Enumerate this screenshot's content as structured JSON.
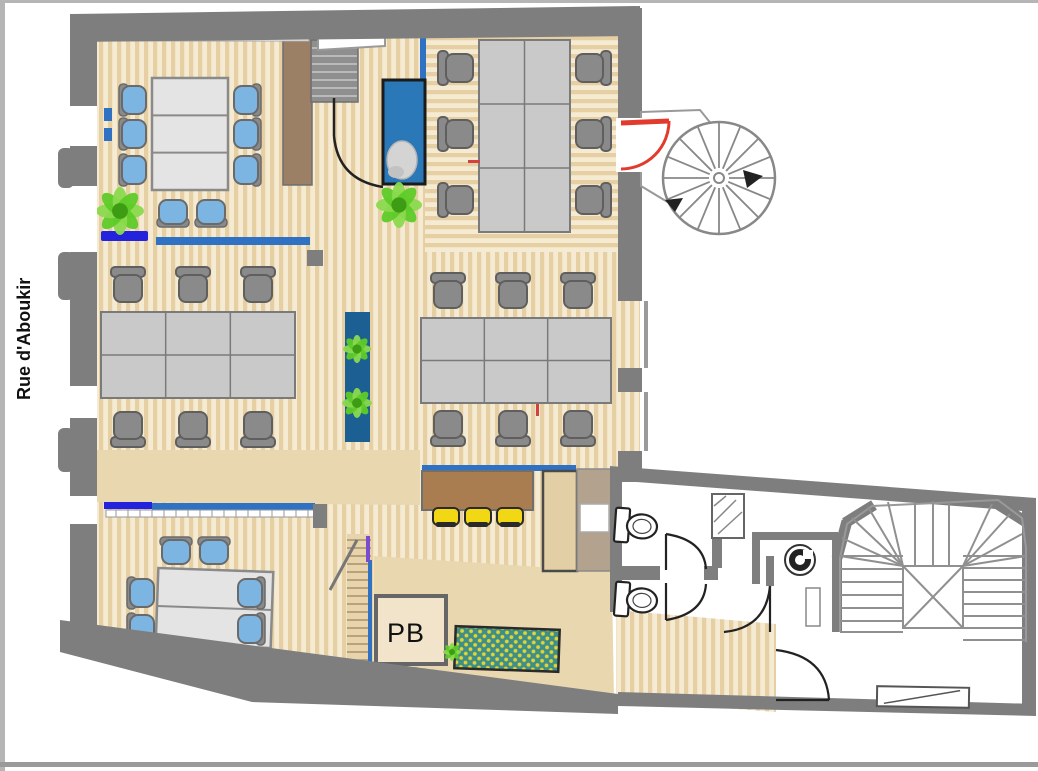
{
  "labels": {
    "street": "Rue d'Aboukir",
    "pb": "PB"
  },
  "colors": {
    "frame": "#b5b5b5",
    "wall": "#7e7e7e",
    "wallLight": "#9a9a9a",
    "floorDark": "#e6cfa3",
    "floorLight": "#f5ead2",
    "floorPlain": "#e9d7b0",
    "desk": "#c9c9c9",
    "deskLine": "#7a7a7a",
    "table": "#e4e4e4",
    "chair": "#8a8a8a",
    "chairEdge": "#5f5f5f",
    "blueChair": "#7db5e2",
    "plant": "#5ecb28",
    "plantLight": "#8bd94e",
    "plantDark": "#3e9c14",
    "glassBlue": "#2f72c4",
    "vividBlue": "#2323dd",
    "purple": "#7a4bd0",
    "aquarium": "#2a78b8",
    "aquariumFrame": "#1b1b1b",
    "planter": "#1c5f93",
    "counter": "#a97d50",
    "woodTrim": "#9b8066",
    "kitchenBlock": "#b3a28e",
    "stool": "#f2d715",
    "mat": "#3f8f86",
    "matDot": "#e3d435",
    "red": "#e23b2e",
    "door": "#222222",
    "stair": "#909090",
    "ladderTread": "#a8916a"
  },
  "plan": {
    "desk_clusters": [
      {
        "x": 479,
        "y": 40,
        "w": 91,
        "h": 192,
        "c": 2,
        "r": 3
      },
      {
        "x": 101,
        "y": 312,
        "w": 194,
        "h": 86,
        "c": 3,
        "r": 2
      },
      {
        "x": 421,
        "y": 318,
        "w": 190,
        "h": 85,
        "c": 3,
        "r": 2
      }
    ],
    "office_chairs": [
      {
        "x": 458,
        "y": 68,
        "b": "left"
      },
      {
        "x": 458,
        "y": 134,
        "b": "left"
      },
      {
        "x": 458,
        "y": 200,
        "b": "left"
      },
      {
        "x": 591,
        "y": 68,
        "b": "right"
      },
      {
        "x": 591,
        "y": 134,
        "b": "right"
      },
      {
        "x": 591,
        "y": 200,
        "b": "right"
      },
      {
        "x": 128,
        "y": 287,
        "b": "top"
      },
      {
        "x": 193,
        "y": 287,
        "b": "top"
      },
      {
        "x": 258,
        "y": 287,
        "b": "top"
      },
      {
        "x": 128,
        "y": 427,
        "b": "bottom"
      },
      {
        "x": 193,
        "y": 427,
        "b": "bottom"
      },
      {
        "x": 258,
        "y": 427,
        "b": "bottom"
      },
      {
        "x": 448,
        "y": 293,
        "b": "top"
      },
      {
        "x": 513,
        "y": 293,
        "b": "top"
      },
      {
        "x": 578,
        "y": 293,
        "b": "top"
      },
      {
        "x": 448,
        "y": 426,
        "b": "bottom"
      },
      {
        "x": 513,
        "y": 426,
        "b": "bottom"
      },
      {
        "x": 578,
        "y": 426,
        "b": "bottom"
      }
    ],
    "meeting_tables": [
      {
        "x": 152,
        "y": 78,
        "w": 76,
        "h": 112,
        "seg": 3,
        "rot": 0
      },
      {
        "x": 157,
        "y": 570,
        "w": 115,
        "h": 76,
        "seg": 2,
        "rot": 2
      }
    ],
    "blue_chairs": [
      {
        "x": 133,
        "y": 100,
        "b": "left"
      },
      {
        "x": 133,
        "y": 134,
        "b": "left"
      },
      {
        "x": 133,
        "y": 170,
        "b": "left"
      },
      {
        "x": 247,
        "y": 100,
        "b": "right"
      },
      {
        "x": 247,
        "y": 134,
        "b": "right"
      },
      {
        "x": 247,
        "y": 170,
        "b": "right"
      },
      {
        "x": 173,
        "y": 213,
        "b": "bottom"
      },
      {
        "x": 211,
        "y": 213,
        "b": "bottom"
      },
      {
        "x": 176,
        "y": 551,
        "b": "top"
      },
      {
        "x": 214,
        "y": 551,
        "b": "top"
      },
      {
        "x": 141,
        "y": 593,
        "b": "left"
      },
      {
        "x": 141,
        "y": 629,
        "b": "left"
      },
      {
        "x": 251,
        "y": 593,
        "b": "right"
      },
      {
        "x": 251,
        "y": 629,
        "b": "right"
      }
    ],
    "plants": [
      {
        "x": 120,
        "y": 211,
        "r": 24
      },
      {
        "x": 399,
        "y": 205,
        "r": 23
      },
      {
        "x": 357,
        "y": 349,
        "r": 14
      },
      {
        "x": 357,
        "y": 403,
        "r": 15
      },
      {
        "x": 452,
        "y": 652,
        "r": 9
      }
    ],
    "stools": [
      {
        "x": 446,
        "y": 517
      },
      {
        "x": 478,
        "y": 517
      },
      {
        "x": 510,
        "y": 517
      }
    ],
    "toilets": [
      {
        "x": 636,
        "y": 526,
        "rot": 4
      },
      {
        "x": 636,
        "y": 600,
        "rot": 4
      }
    ]
  }
}
